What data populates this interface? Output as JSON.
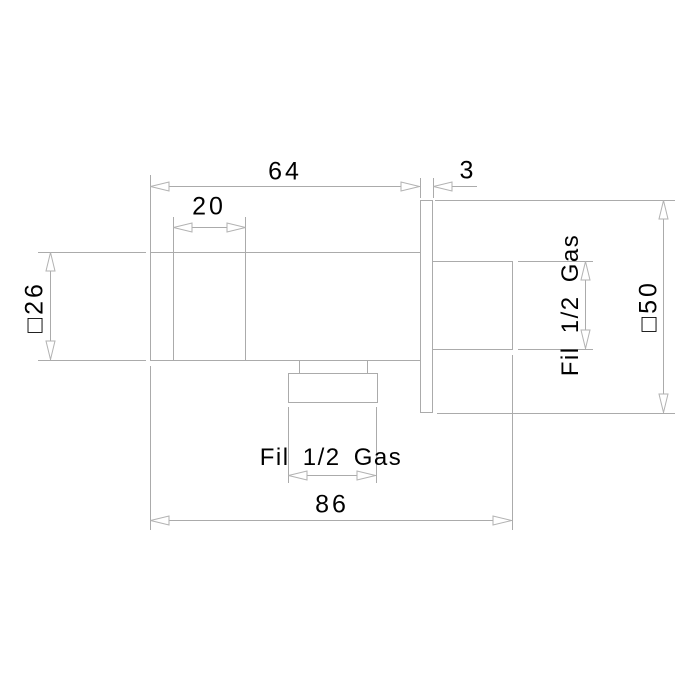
{
  "drawing": {
    "type": "technical-dimension-drawing",
    "background": "#ffffff",
    "line_color": "#ababab",
    "text_color": "#000000",
    "labels": {
      "depth_64": "64",
      "plate_3": "3",
      "front_20": "20",
      "square_26": "□26",
      "square_50": "□50",
      "thread_rear": "Fil 1/2 Gas",
      "thread_outlet": "Fil 1/2 Gas",
      "total_86": "86"
    }
  }
}
